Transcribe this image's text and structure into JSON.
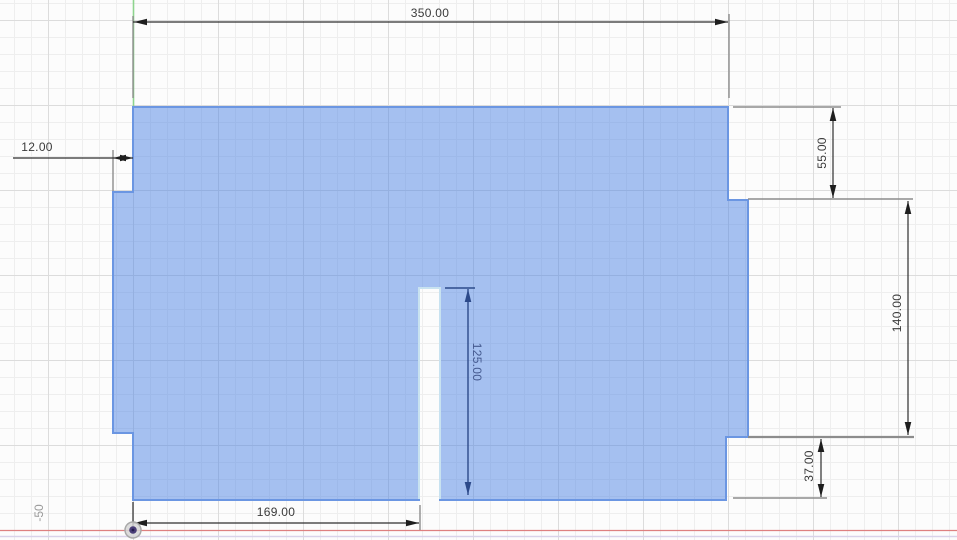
{
  "view": {
    "type_label": "sketch-canvas",
    "grid_label_minus50": "-50",
    "dimensions": {
      "top_width": "350.00",
      "left_step": "12.00",
      "right_upper": "55.00",
      "right_height": "140.00",
      "right_lower": "37.00",
      "slot_depth": "125.00",
      "bottom_width": "169.00"
    },
    "colors": {
      "profile_fill": "#a6c1f1",
      "sketch_line": "#6b96e2",
      "slot_line": "#c8e2f0",
      "dimension_line": "#2e2e2e",
      "extension_line": "#8c8c8c",
      "selected_dimension": "#3a4f8e",
      "x_axis": "#de8080",
      "y_axis": "#8ed48e",
      "ground_line": "#d9d2e9"
    }
  }
}
